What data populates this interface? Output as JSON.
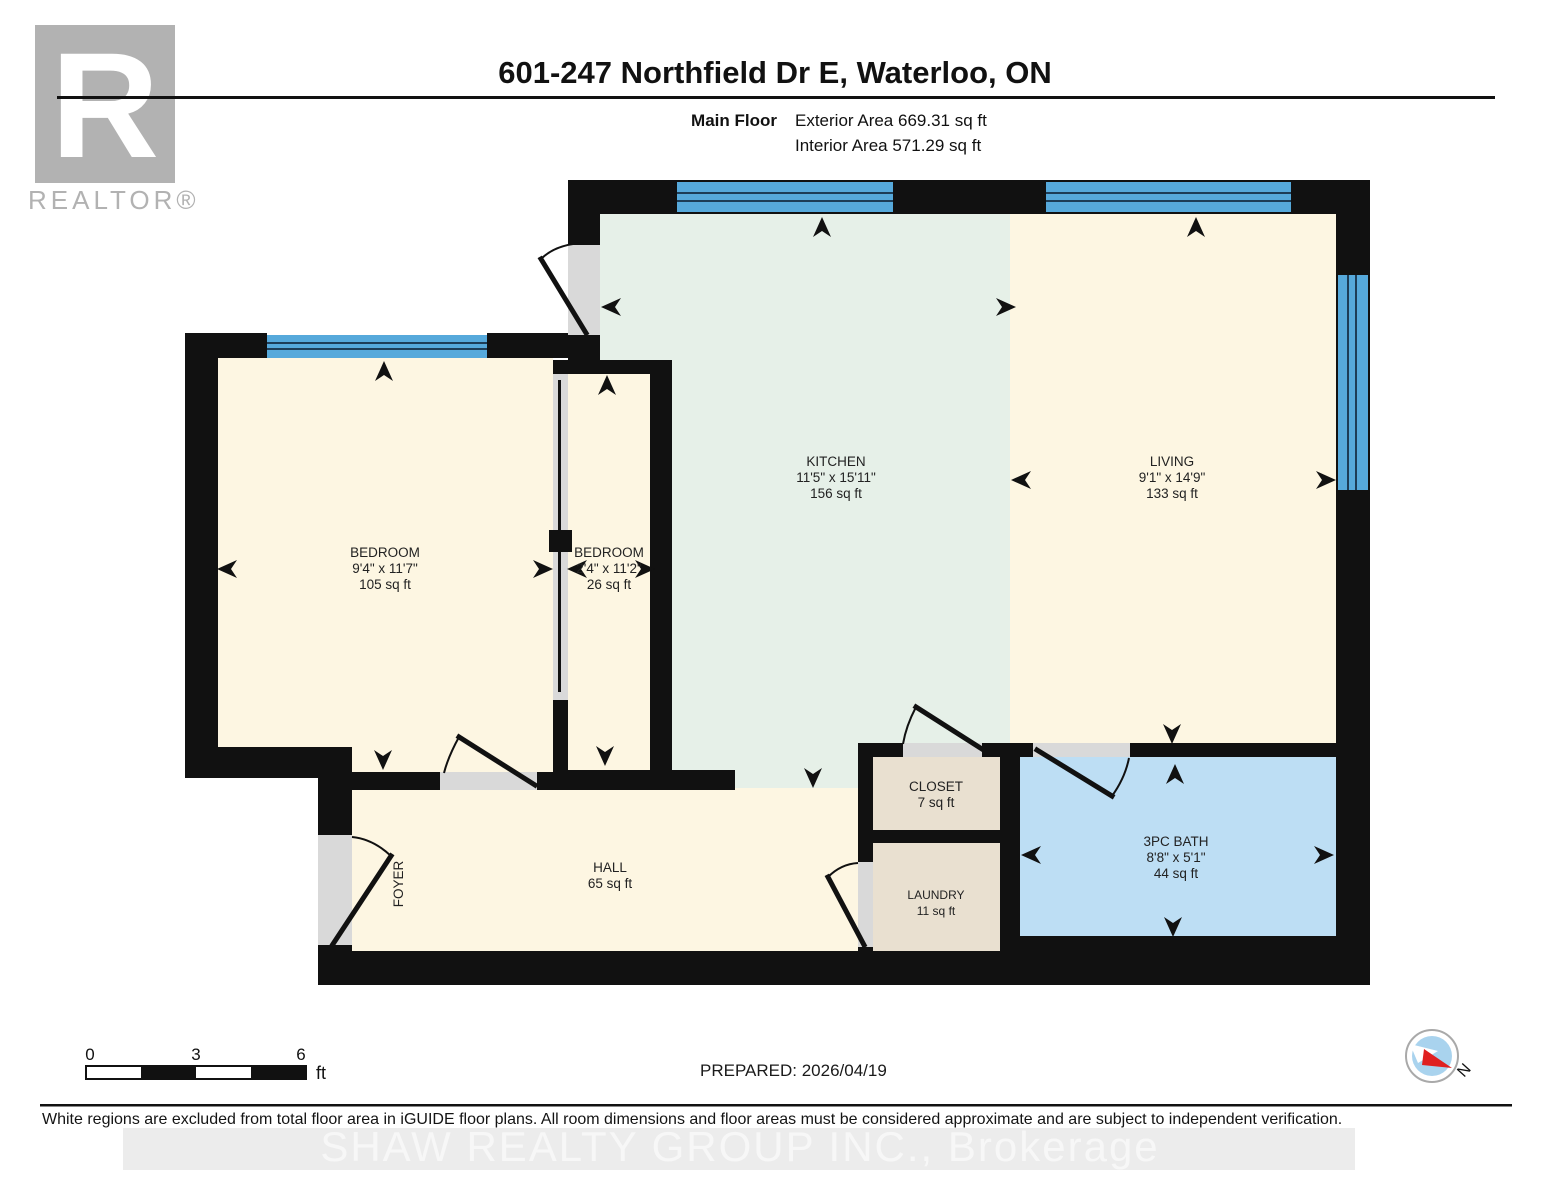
{
  "header": {
    "title": "601-247 Northfield Dr E, Waterloo, ON",
    "floor_label": "Main Floor",
    "exterior_area": "Exterior Area 669.31 sq ft",
    "interior_area": "Interior Area 571.29 sq ft"
  },
  "logo": {
    "letter": "R",
    "label": "REALTOR®"
  },
  "rooms": {
    "kitchen": {
      "name": "KITCHEN",
      "dims": "11'5\" x 15'11\"",
      "area": "156 sq ft"
    },
    "living": {
      "name": "LIVING",
      "dims": "9'1\" x 14'9\"",
      "area": "133 sq ft"
    },
    "bedroom1": {
      "name": "BEDROOM",
      "dims": "9'4\" x 11'7\"",
      "area": "105 sq ft"
    },
    "bedroom2": {
      "name": "BEDROOM",
      "dims": "2'4\" x 11'2\"",
      "area": "26 sq ft"
    },
    "closet": {
      "name": "CLOSET",
      "area": "7 sq ft"
    },
    "laundry": {
      "name": "LAUNDRY",
      "area": "11 sq ft"
    },
    "bath": {
      "name": "3PC BATH",
      "dims": "8'8\" x 5'1\"",
      "area": "44 sq ft"
    },
    "hall": {
      "name": "HALL",
      "area": "65 sq ft"
    },
    "foyer": {
      "name": "FOYER"
    }
  },
  "scale_bar": {
    "tick_0": "0",
    "tick_3": "3",
    "tick_6": "6",
    "unit": "ft"
  },
  "prepared_label": "PREPARED: 2026/04/19",
  "compass": {
    "north_label": "N"
  },
  "footer": {
    "disclaimer": "White regions are excluded from total floor area in iGUIDE floor plans. All room dimensions and floor areas must be considered approximate and are subject to independent verification.",
    "watermark": "SHAW REALTY GROUP INC., Brokerage"
  },
  "colors": {
    "wall": "#111111",
    "kitchen_fill": "#e6f0e8",
    "room_fill": "#fdf6e2",
    "storage_fill": "#e9e0d0",
    "bath_fill": "#bddef4",
    "window_blue": "#56a9db",
    "door_opening": "#d9d9d9",
    "logo_gray": "#b2b2b2",
    "compass_red": "#e02020",
    "compass_blue": "#a9d3ee"
  }
}
